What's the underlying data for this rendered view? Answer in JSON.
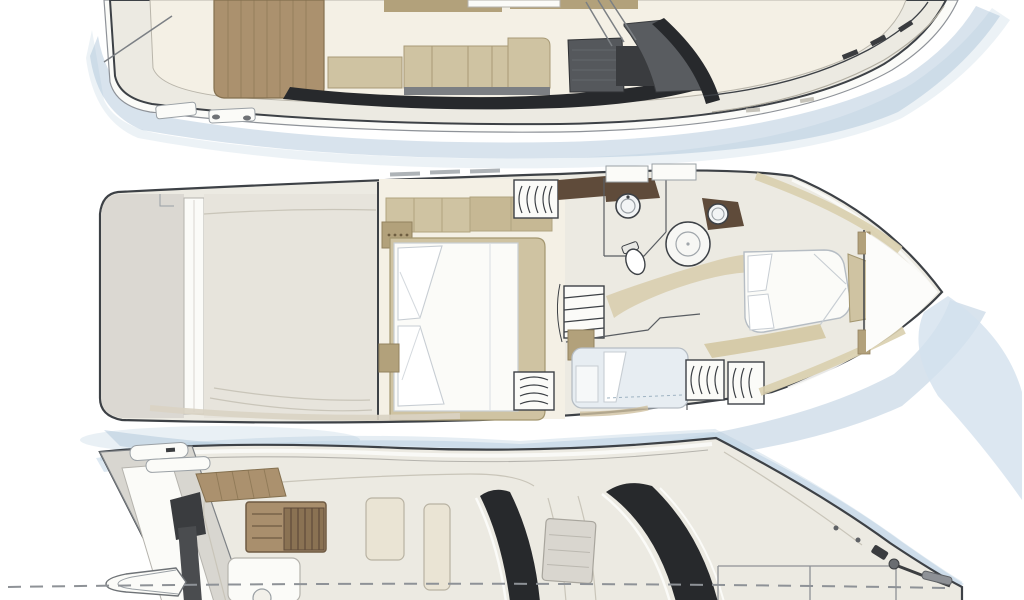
{
  "image": {
    "kind": "motor yacht deck plan line drawing",
    "boat_count": 3,
    "orientation": "bows pointing right",
    "background": "#ffffff"
  },
  "colors": {
    "line": "#3d4146",
    "rim": "#fbfbf8",
    "hull": "#eceae2",
    "deck_gray": "#dbd8d2",
    "garage_gray": "#e7e4dc",
    "floor": "#f4f0e5",
    "teak": "#ab916e",
    "teak_line": "#84704f",
    "furniture": "#cfc3a2",
    "furniture_dark": "#b2a17b",
    "charcoal": "#3a3c3f",
    "galley_gray": "#55585c",
    "bulwark_black": "#27292c",
    "mattress": "#fbfbf8",
    "mattress_shade": "#e7edf2",
    "wood_brown": "#5f4b3a",
    "stair_wood": "#a98f6d",
    "stair_wood_dark": "#8a7253",
    "shadow_blue": "#a9c2d8",
    "shadow_blue_light": "#d3e1ee"
  },
  "decks": [
    {
      "name": "main deck",
      "position": "top",
      "cropped_edge": "top",
      "features": [
        "aft cockpit with teak sole",
        "cockpit hatches and cleats",
        "saloon C-sofa",
        "side cabinet",
        "dinette furniture",
        "galley block",
        "helm console",
        "companionway stair rails",
        "dark side-deck bulwark",
        "foredeck walkway",
        "bow window ticks"
      ]
    },
    {
      "name": "lower deck",
      "position": "middle",
      "cropped_edge": "none",
      "features": [
        "stern platform",
        "transom steps",
        "tender garage / engine room",
        "master cabin with double bed and pillows",
        "bedside cabinets",
        "hanging wardrobes",
        "companionway stairs",
        "day head with round sink and toilet",
        "circular shower stall",
        "vip bathroom sink",
        "guest berth cabin",
        "forward vip cabin island bed",
        "chain locker bulkhead"
      ]
    },
    {
      "name": "flybridge and exterior",
      "position": "bottom",
      "cropped_edge": "bottom",
      "features": [
        "passerelle",
        "radar arch with antennas",
        "teak step pad",
        "flybridge staircase",
        "flybridge benches",
        "sun pad with cocktail table",
        "hardtop sunroof",
        "two dark windscreen bands",
        "foredeck sun pad outline",
        "anchor windlass and bow pulpit",
        "side rail dashed stanchions"
      ]
    }
  ]
}
